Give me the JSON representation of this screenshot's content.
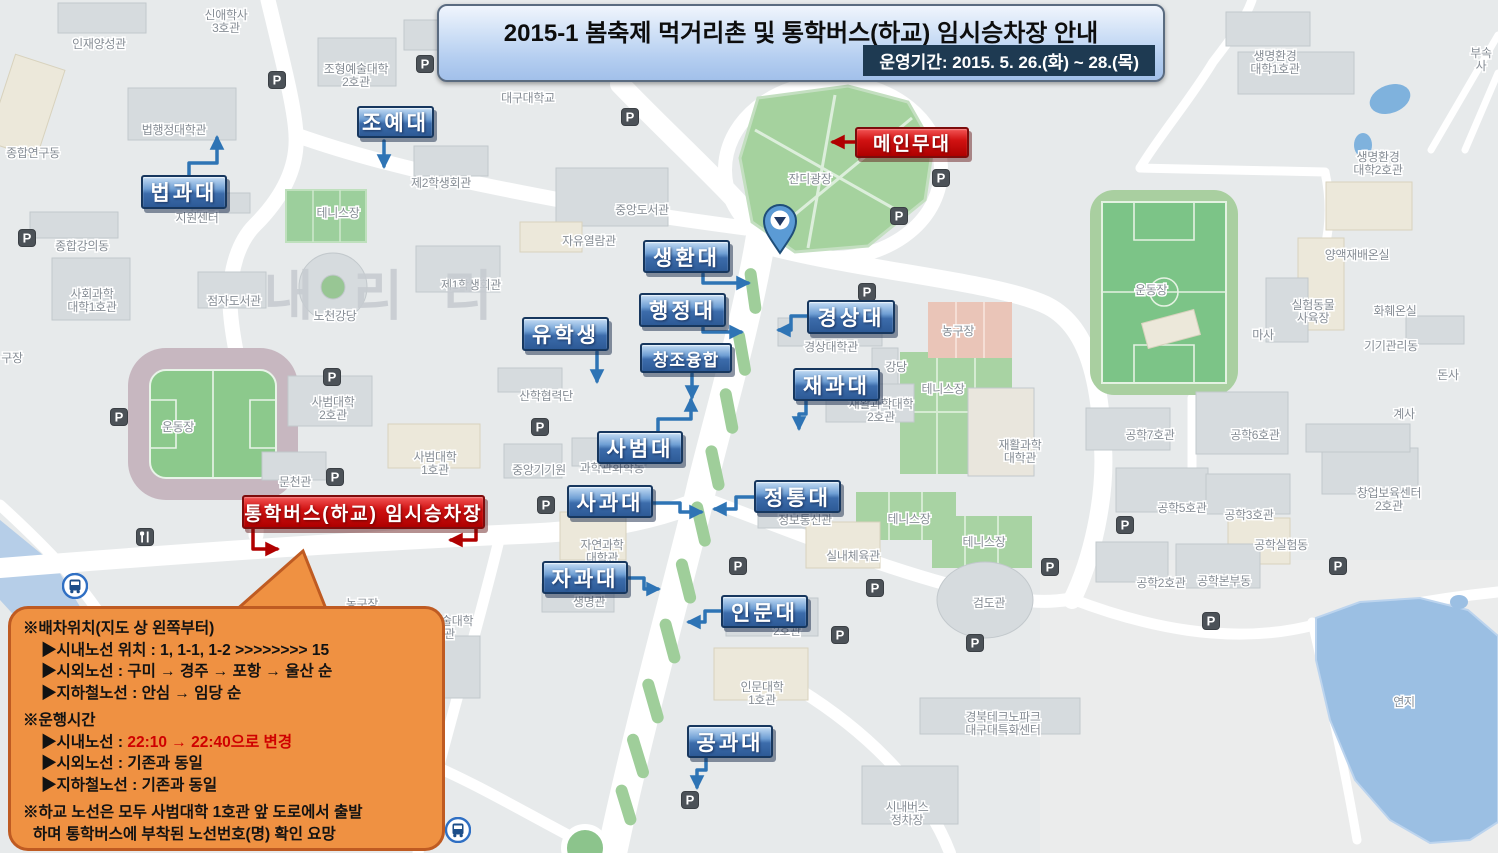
{
  "banner": {
    "title": "2015-1 봄축제 먹거리촌 및 통학버스(하교) 임시승차장 안내",
    "period": "운영기간: 2015. 5. 26.(화) ~ 28.(목)"
  },
  "bubble": {
    "lines": [
      {
        "t": "※배차위치(지도 상 왼쪽부터)",
        "ind": 0
      },
      {
        "t": "▶시내노선 위치 : 1, 1-1, 1-2 >>>>>>>> 15",
        "ind": 1
      },
      {
        "t": "▶시외노선 : 구미 → 경주 → 포항 → 울산 순",
        "ind": 1
      },
      {
        "t": "▶지하철노선 : 안심 → 임당 순",
        "ind": 1
      },
      {
        "t": "※운행시간",
        "ind": 0,
        "gap": 1
      },
      {
        "parts": [
          {
            "t": "▶시내노선 : "
          },
          {
            "t": "22:10 → 22:40으로 변경",
            "red": 1
          }
        ],
        "ind": 1
      },
      {
        "t": "▶시외노선 : 기존과 동일",
        "ind": 1
      },
      {
        "t": "▶지하철노선 : 기존과 동일",
        "ind": 1
      },
      {
        "t": "※하교 노선은 모두 사범대학 1호관 앞 도로에서 출발",
        "ind": 0,
        "gap": 1
      },
      {
        "t": "하며 통학버스에 부착된 노선번호(명) 확인 요망",
        "ind": 0.5
      }
    ]
  },
  "callouts": [
    {
      "t": "조예대",
      "n": "callout-joyedae",
      "x": 357,
      "y": 106,
      "w": 77,
      "h": 32,
      "c": "blue"
    },
    {
      "t": "법과대",
      "n": "callout-beopgwadae",
      "x": 141,
      "y": 175,
      "w": 86,
      "h": 34,
      "c": "blue"
    },
    {
      "t": "생환대",
      "n": "callout-saenghwandae",
      "x": 643,
      "y": 240,
      "w": 87,
      "h": 33,
      "c": "blue"
    },
    {
      "t": "행정대",
      "n": "callout-haengjeongdae",
      "x": 639,
      "y": 293,
      "w": 87,
      "h": 34,
      "c": "blue"
    },
    {
      "t": "유학생",
      "n": "callout-international-students",
      "x": 522,
      "y": 317,
      "w": 87,
      "h": 34,
      "c": "blue"
    },
    {
      "t": "창조융합",
      "n": "callout-changjo-yunghap",
      "x": 640,
      "y": 343,
      "w": 92,
      "h": 30,
      "c": "blue",
      "small": 1
    },
    {
      "t": "경상대",
      "n": "callout-gyeongsangdae",
      "x": 807,
      "y": 300,
      "w": 88,
      "h": 34,
      "c": "blue"
    },
    {
      "t": "재과대",
      "n": "callout-jaegwadae",
      "x": 793,
      "y": 368,
      "w": 87,
      "h": 33,
      "c": "blue"
    },
    {
      "t": "사범대",
      "n": "callout-sabeomdae",
      "x": 597,
      "y": 431,
      "w": 86,
      "h": 33,
      "c": "blue"
    },
    {
      "t": "사과대",
      "n": "callout-sagwadae",
      "x": 567,
      "y": 485,
      "w": 86,
      "h": 33,
      "c": "blue"
    },
    {
      "t": "정통대",
      "n": "callout-jeongtongdae",
      "x": 754,
      "y": 480,
      "w": 87,
      "h": 33,
      "c": "blue"
    },
    {
      "t": "자과대",
      "n": "callout-jagwadae",
      "x": 542,
      "y": 561,
      "w": 86,
      "h": 33,
      "c": "blue"
    },
    {
      "t": "인문대",
      "n": "callout-inmundae",
      "x": 721,
      "y": 595,
      "w": 87,
      "h": 33,
      "c": "blue"
    },
    {
      "t": "공과대",
      "n": "callout-gonggwadae",
      "x": 687,
      "y": 725,
      "w": 86,
      "h": 33,
      "c": "blue"
    },
    {
      "t": "메인무대",
      "n": "callout-main-stage",
      "x": 855,
      "y": 127,
      "w": 114,
      "h": 31,
      "c": "red"
    },
    {
      "t": "통학버스(하교) 임시승차장",
      "n": "callout-shuttle-bus-stop",
      "x": 242,
      "y": 495,
      "w": 243,
      "h": 34,
      "c": "red"
    }
  ],
  "arrows": [
    {
      "c": "blue",
      "pts": [
        [
          384,
          141
        ],
        [
          384,
          166
        ]
      ]
    },
    {
      "c": "blue",
      "pts": [
        [
          189,
          176
        ],
        [
          189,
          163
        ],
        [
          217,
          163
        ],
        [
          217,
          138
        ]
      ]
    },
    {
      "c": "blue",
      "pts": [
        [
          703,
          274
        ],
        [
          703,
          283
        ],
        [
          748,
          283
        ]
      ]
    },
    {
      "c": "blue",
      "pts": [
        [
          703,
          328
        ],
        [
          703,
          332
        ],
        [
          741,
          332
        ]
      ]
    },
    {
      "c": "blue",
      "pts": [
        [
          597,
          352
        ],
        [
          597,
          381
        ]
      ]
    },
    {
      "c": "blue",
      "pts": [
        [
          692,
          374
        ],
        [
          692,
          397
        ]
      ]
    },
    {
      "c": "blue",
      "pts": [
        [
          658,
          432
        ],
        [
          658,
          419
        ],
        [
          691,
          419
        ],
        [
          691,
          400
        ]
      ]
    },
    {
      "c": "blue",
      "pts": [
        [
          653,
          503
        ],
        [
          680,
          503
        ],
        [
          680,
          512
        ],
        [
          701,
          512
        ]
      ]
    },
    {
      "c": "blue",
      "pts": [
        [
          807,
          316
        ],
        [
          791,
          316
        ],
        [
          791,
          330
        ],
        [
          779,
          330
        ]
      ]
    },
    {
      "c": "blue",
      "pts": [
        [
          806,
          401
        ],
        [
          806,
          414
        ],
        [
          799,
          414
        ],
        [
          799,
          428
        ]
      ]
    },
    {
      "c": "blue",
      "pts": [
        [
          754,
          497
        ],
        [
          736,
          497
        ],
        [
          736,
          509
        ],
        [
          715,
          509
        ]
      ]
    },
    {
      "c": "blue",
      "pts": [
        [
          629,
          578
        ],
        [
          644,
          578
        ],
        [
          644,
          589
        ],
        [
          658,
          589
        ]
      ]
    },
    {
      "c": "blue",
      "pts": [
        [
          721,
          611
        ],
        [
          705,
          611
        ],
        [
          705,
          622
        ],
        [
          689,
          622
        ]
      ]
    },
    {
      "c": "blue",
      "pts": [
        [
          706,
          759
        ],
        [
          706,
          770
        ],
        [
          697,
          770
        ],
        [
          697,
          787
        ]
      ]
    },
    {
      "c": "red",
      "pts": [
        [
          855,
          142
        ],
        [
          833,
          142
        ]
      ]
    },
    {
      "c": "red",
      "pts": [
        [
          253,
          529
        ],
        [
          253,
          549
        ],
        [
          277,
          549
        ]
      ]
    },
    {
      "c": "red",
      "pts": [
        [
          476,
          529
        ],
        [
          476,
          540
        ],
        [
          451,
          540
        ]
      ]
    }
  ],
  "map": {
    "watermark": "내리리",
    "places": [
      {
        "t": "인재양성관",
        "x": 99,
        "y": 45
      },
      {
        "t": "신애학사\n3호관",
        "x": 226,
        "y": 16
      },
      {
        "t": "조형예술대학\n2호관",
        "x": 356,
        "y": 70
      },
      {
        "t": "법행정대학관",
        "x": 174,
        "y": 131
      },
      {
        "t": "종합연구동",
        "x": 33,
        "y": 154
      },
      {
        "t": "제2학생회관",
        "x": 441,
        "y": 184
      },
      {
        "t": "대구대학교",
        "x": 528,
        "y": 99,
        "c": "#4168c8",
        "s": 16,
        "b": 1
      },
      {
        "t": "지원센터",
        "x": 197,
        "y": 219
      },
      {
        "t": "테니스장",
        "x": 338,
        "y": 214,
        "c": "#74876f"
      },
      {
        "t": "종합강의동",
        "x": 82,
        "y": 247
      },
      {
        "t": "중앙도서관",
        "x": 642,
        "y": 211
      },
      {
        "t": "자유열람관",
        "x": 589,
        "y": 242
      },
      {
        "t": "사회과학\n대학1호관",
        "x": 92,
        "y": 295
      },
      {
        "t": "제1학생회관",
        "x": 471,
        "y": 286
      },
      {
        "t": "점자도서관",
        "x": 234,
        "y": 302
      },
      {
        "t": "노천강당",
        "x": 335,
        "y": 317
      },
      {
        "t": "잔디광장",
        "x": 810,
        "y": 180,
        "c": "#7d8f7c"
      },
      {
        "t": "운동장",
        "x": 178,
        "y": 428,
        "c": "#74876f"
      },
      {
        "t": "구장",
        "x": 12,
        "y": 359
      },
      {
        "t": "문천관",
        "x": 295,
        "y": 483
      },
      {
        "t": "사범대학\n2호관",
        "x": 333,
        "y": 403
      },
      {
        "t": "사범대학\n1호관",
        "x": 435,
        "y": 458
      },
      {
        "t": "산학협력단",
        "x": 546,
        "y": 397
      },
      {
        "t": "중앙기기원",
        "x": 539,
        "y": 471
      },
      {
        "t": "과학관화학동",
        "x": 612,
        "y": 469
      },
      {
        "t": "자연과학\n대학관",
        "x": 602,
        "y": 546
      },
      {
        "t": "생명관",
        "x": 589,
        "y": 603
      },
      {
        "t": "조형예술대학\n5호관",
        "x": 441,
        "y": 622
      },
      {
        "t": "농구장",
        "x": 362,
        "y": 605
      },
      {
        "t": "경상대학관",
        "x": 831,
        "y": 348
      },
      {
        "t": "강당",
        "x": 896,
        "y": 368
      },
      {
        "t": "테니스장",
        "x": 943,
        "y": 390,
        "c": "#74876f"
      },
      {
        "t": "재활과학대학\n2호관",
        "x": 881,
        "y": 405
      },
      {
        "t": "재활과학\n대학관",
        "x": 1020,
        "y": 446
      },
      {
        "t": "농구장",
        "x": 958,
        "y": 332
      },
      {
        "t": "정보통신관",
        "x": 805,
        "y": 521
      },
      {
        "t": "실내체육관",
        "x": 853,
        "y": 557
      },
      {
        "t": "테니스장",
        "x": 909,
        "y": 520,
        "c": "#74876f"
      },
      {
        "t": "테니스장",
        "x": 984,
        "y": 543,
        "c": "#74876f"
      },
      {
        "t": "검도관",
        "x": 989,
        "y": 604
      },
      {
        "t": "2호관",
        "x": 787,
        "y": 632
      },
      {
        "t": "인문대학\n1호관",
        "x": 762,
        "y": 688
      },
      {
        "t": "경북테크노파크\n대구대특화센터",
        "x": 1003,
        "y": 718
      },
      {
        "t": "시내버스\n정차장",
        "x": 907,
        "y": 808
      },
      {
        "t": "운동장",
        "x": 1151,
        "y": 291,
        "c": "#74876f"
      },
      {
        "t": "마사",
        "x": 1263,
        "y": 336
      },
      {
        "t": "공학7호관",
        "x": 1150,
        "y": 436
      },
      {
        "t": "공학6호관",
        "x": 1255,
        "y": 436
      },
      {
        "t": "공학5호관",
        "x": 1182,
        "y": 509
      },
      {
        "t": "공학3호관",
        "x": 1249,
        "y": 516
      },
      {
        "t": "창업보육센터\n2호관",
        "x": 1389,
        "y": 494
      },
      {
        "t": "공학실험동",
        "x": 1281,
        "y": 546
      },
      {
        "t": "공학2호관",
        "x": 1161,
        "y": 584
      },
      {
        "t": "공학본부동",
        "x": 1224,
        "y": 582
      },
      {
        "t": "계사",
        "x": 1404,
        "y": 415
      },
      {
        "t": "돈사",
        "x": 1448,
        "y": 376
      },
      {
        "t": "기기관리동",
        "x": 1391,
        "y": 347
      },
      {
        "t": "화훼온실",
        "x": 1395,
        "y": 312
      },
      {
        "t": "실험동물\n사육장",
        "x": 1313,
        "y": 306
      },
      {
        "t": "양액재배온실",
        "x": 1357,
        "y": 256
      },
      {
        "t": "생명환경\n대학1호관",
        "x": 1275,
        "y": 57
      },
      {
        "t": "생명환경\n대학2호관",
        "x": 1378,
        "y": 158
      },
      {
        "t": "연지",
        "x": 1404,
        "y": 703,
        "s": 15
      },
      {
        "t": "부속\n사",
        "x": 1481,
        "y": 54
      }
    ]
  },
  "icons": {
    "parking": [
      [
        27,
        238
      ],
      [
        277,
        80
      ],
      [
        425,
        64
      ],
      [
        630,
        117
      ],
      [
        941,
        178
      ],
      [
        899,
        216
      ],
      [
        867,
        292
      ],
      [
        332,
        377
      ],
      [
        119,
        417
      ],
      [
        335,
        477
      ],
      [
        540,
        427
      ],
      [
        546,
        505
      ],
      [
        738,
        566
      ],
      [
        875,
        588
      ],
      [
        1050,
        567
      ],
      [
        840,
        635
      ],
      [
        975,
        643
      ],
      [
        690,
        800
      ],
      [
        1125,
        525
      ],
      [
        1338,
        566
      ],
      [
        1211,
        621
      ]
    ],
    "bus": [
      [
        75,
        586
      ],
      [
        458,
        830
      ]
    ],
    "restaurant": [
      [
        145,
        537
      ]
    ]
  },
  "colors": {
    "blue_callout": "#2d5a96",
    "red_callout": "#c00000",
    "arrow_blue": "#2e74b5",
    "arrow_red": "#b00000",
    "bubble_bg": "#ef9142",
    "bubble_border": "#bf5b22",
    "banner_bg": "#b3cdf0",
    "banner_period_bg": "#1e3a52",
    "map_bg": "#e7eaeb",
    "lawn_green": "#a5d29e",
    "field_green": "#7cc487",
    "water_blue": "#9bbfe3"
  }
}
